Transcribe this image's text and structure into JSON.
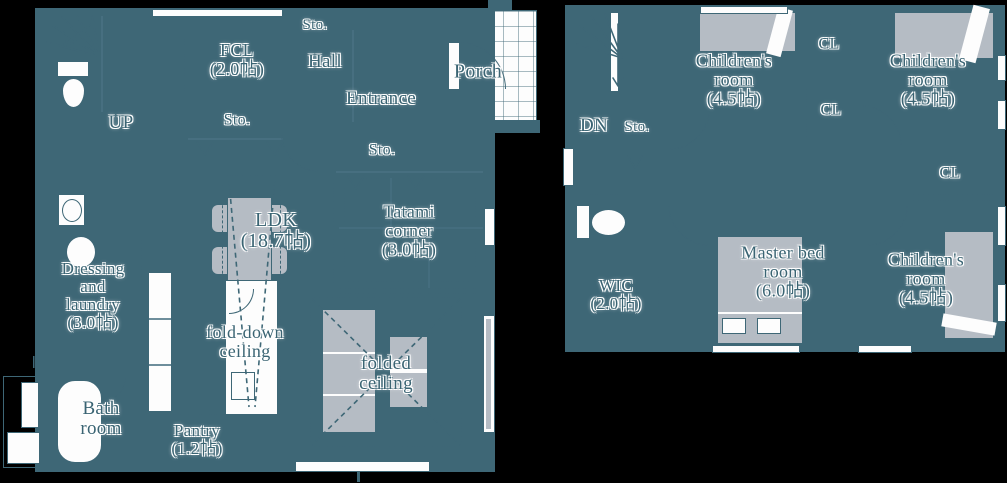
{
  "palette": {
    "wall": "#3e6776",
    "room_fill": "#fdfdfd",
    "furniture_gray": "#b5bcc4",
    "background": "#000000",
    "text": "#3a6473"
  },
  "floor1": {
    "fcl": "FCL\n(2.0帖)",
    "sto_hall": "Sto.",
    "hall": "Hall",
    "entrance": "Entrance",
    "porch": "Porch",
    "sto_fcl": "Sto.",
    "sto_tatami": "Sto.",
    "up": "UP",
    "ldk": "LDK\n(18.7帖)",
    "tatami_corner": "Tatami\ncorner\n(3.0帖)",
    "dressing": "Dressing\nand\nlaundry\n(3.0帖)",
    "fold_down_ceiling": "fold-down\nceiling",
    "folded_ceiling": "folded\nceiling",
    "bath": "Bath\nroom",
    "pantry": "Pantry\n(1.2帖)"
  },
  "floor2": {
    "dn": "DN",
    "sto": "Sto.",
    "children_room_1": "Children's\nroom\n(4.5帖)",
    "children_room_2": "Children's\nroom\n(4.5帖)",
    "children_room_3": "Children's\nroom\n(4.5帖)",
    "cl_1": "CL",
    "cl_2": "CL",
    "cl_3": "CL",
    "wic": "WIC\n(2.0帖)",
    "master_bedroom": "Master bed\nroom\n(6.0帖)"
  }
}
